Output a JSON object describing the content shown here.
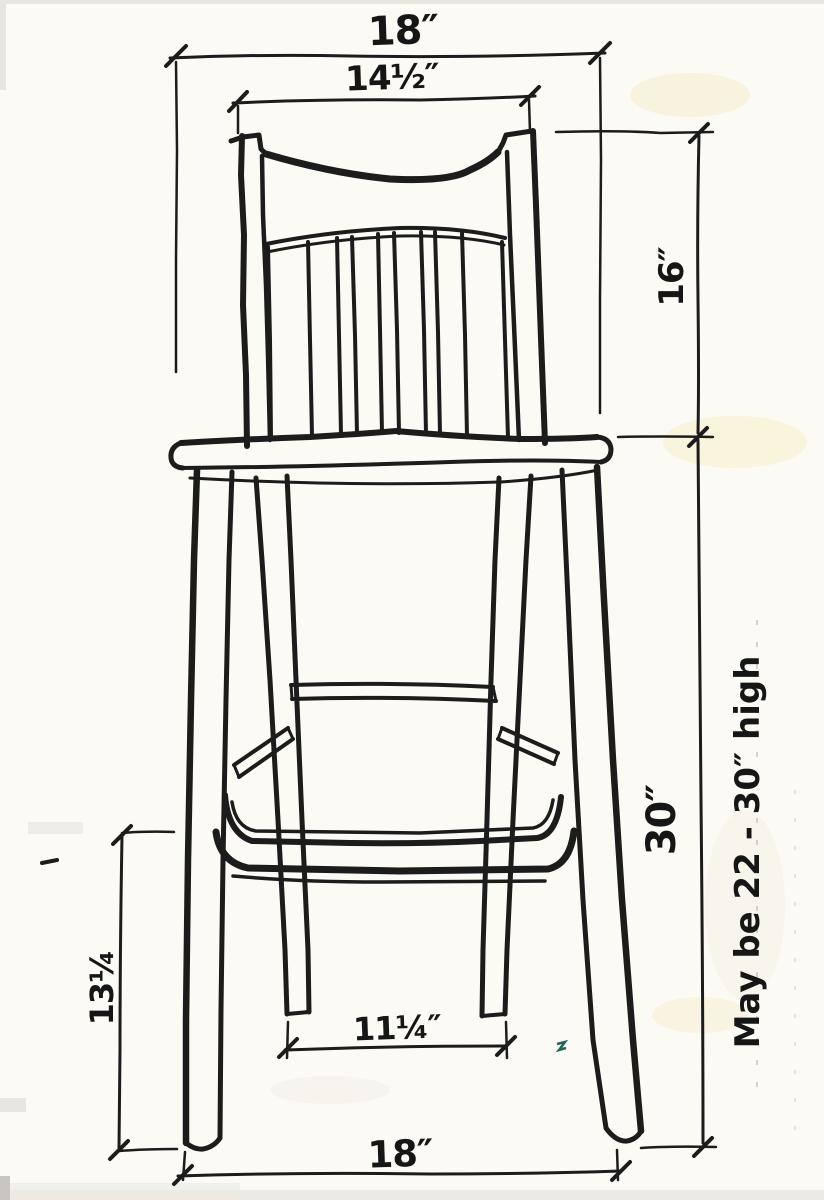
{
  "sketch": {
    "dimensions": {
      "top_width": "18″",
      "back_width": "14½″",
      "back_height": "16″",
      "seat_height": "30″",
      "stretcher_height": "13¼",
      "rear_feet_span": "11¼″",
      "bottom_width": "18″"
    },
    "note": "May be 22 - 30″ high",
    "colors": {
      "ink": "#1c1c1c",
      "paper": "#fbfaf5",
      "stain": "#f5ecc9",
      "speck": "#23635a"
    }
  }
}
